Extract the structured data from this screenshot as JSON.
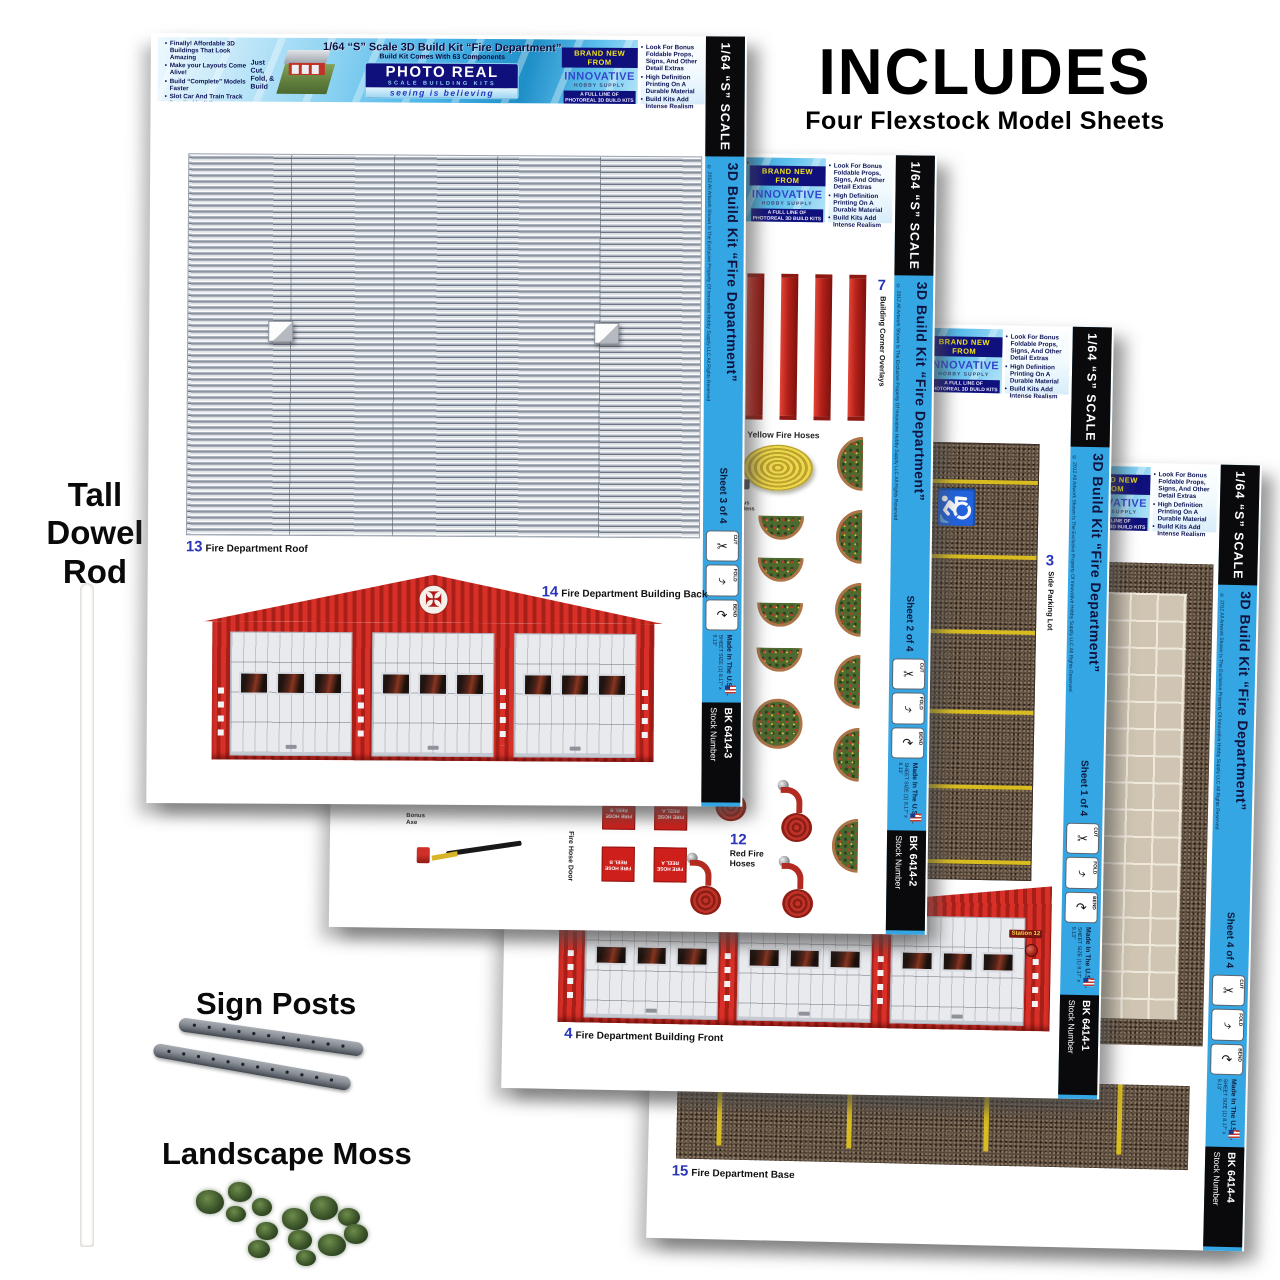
{
  "includes": {
    "title": "INCLUDES",
    "subtitle": "Four Flexstock Model Sheets"
  },
  "left_panel": {
    "dowel": "Tall Dowel Rod",
    "sign_posts": "Sign Posts",
    "moss": "Landscape Moss"
  },
  "header": {
    "left_bullets": [
      "Finally! Affordable 3D Buildings That Look Amazing",
      "Make your Layouts Come Alive!",
      "Build “Complete” Models Faster",
      "Slot Car And Train Track Detailed buildings"
    ],
    "cut_fold_build": "Just Cut, Fold, & Build",
    "title_line1": "1/64 “S” Scale 3D Build Kit  “Fire Department”",
    "title_line2": "Build Kit Comes With 63 Components",
    "logo_name": "PHOTO REAL",
    "logo_sub": "SCALE BUILDING KITS",
    "logo_tag": "seeing is believing",
    "brand_new": "BRAND NEW FROM",
    "innovative": "INNOVATIVE",
    "hobby": "HOBBY SUPPLY",
    "full_line": "A FULL LINE OF PHOTOREAL 3D BUILD KITS & MODELSKINZ AVAILABLE",
    "right_bullets": [
      "Look For Bonus Foldable Props, Signs, And Other Detail Extras",
      "High Definition Printing On A Durable Material",
      "Build Kits Add Intense Realism"
    ]
  },
  "sidebar": {
    "scale": "1/64 “S” SCALE",
    "copyright": "© 2012 All Artwork Shown Is The Exclusive Property Of Innovative Hobby Supply LLC All Rights Reserved",
    "kit_title": "3D Build Kit  “Fire Department”",
    "cut": "CUT",
    "fold": "FOLD",
    "bend": "BEND",
    "sheet_size": "SHEET SIZE (1) 8.17” x 9.13”",
    "made_in": "Made In The U.S.A.",
    "stock_label": "Stock Number"
  },
  "icons": {
    "cut": "✂",
    "fold": "⤷",
    "bend": "↷",
    "handicap": "♿",
    "maltese": "✠"
  },
  "s3": {
    "no": "Sheet 3 of 4",
    "stock": "BK 6414-3",
    "roof_num": "13",
    "roof_label": "Fire Department Roof",
    "back_num": "14",
    "back_label": "Fire Department Building Back"
  },
  "s2": {
    "no": "Sheet 2 of 4",
    "stock": "BK 6414-2",
    "overlays_num": "7",
    "overlays_label": "Building Corner Overlays",
    "yellow_hoses": "Yellow Fire Hoses",
    "bonus_gardens": "Bonus Gardens",
    "bonus_axe": "Bonus Axe",
    "fire_hose_door": "Fire Hose Door",
    "reel_a": "FIRE HOSE REEL A",
    "reel_b": "FIRE HOSE REEL B",
    "red_hoses_num": "12",
    "red_hoses_label": "Red Fire Hoses"
  },
  "s1": {
    "no": "Sheet 1 of 4",
    "stock": "BK 6414-1",
    "parking_num": "3",
    "parking_label": "Side Parking Lot",
    "front_num": "4",
    "front_label": "Fire Department Building Front",
    "station_sign": "Station 12",
    "address": "1073"
  },
  "s4": {
    "no": "Sheet 4 of 4",
    "stock": "BK 6414-4",
    "base_num": "15",
    "base_label": "Fire Department Base"
  }
}
